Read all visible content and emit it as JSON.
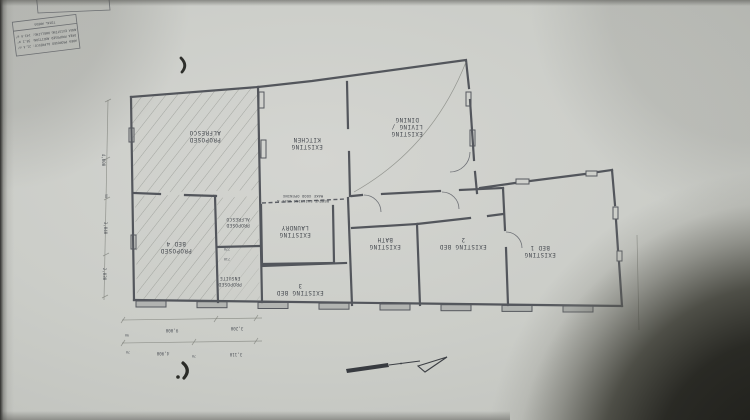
{
  "drawing": {
    "orientation_note": "plan photographed upside-down",
    "title_block": {
      "title": "TOTAL AREAS",
      "rows": [
        "AREA EXISTING DWELLING: 143.6 m²",
        "AREA PROPOSED ADDITION: 38.2 m²",
        "AREA PROPOSED ALFRESCO: 21.4 m²"
      ]
    },
    "rooms": {
      "alfresco1": {
        "l1": "PROPOSED",
        "l2": "ALFRESCO"
      },
      "kitchen": {
        "l1": "EXISTING",
        "l2": "KITCHEN"
      },
      "living": {
        "l1": "EXISTING",
        "l2": "LIVING /",
        "l3": "DINING"
      },
      "laundry": {
        "l1": "EXISTING",
        "l2": "LAUNDRY"
      },
      "alfresco2": {
        "l1": "PROPOSED",
        "l2": "ALFRESCO"
      },
      "bed4": {
        "l1": "PROPOSED",
        "l2": "BED 4"
      },
      "ensuite": {
        "l1": "PROPOSED",
        "l2": "ENSUITE"
      },
      "bed3": {
        "l1": "EXISTING BED",
        "l2": "3"
      },
      "bath": {
        "l1": "EXISTING",
        "l2": "BATH"
      },
      "bed2": {
        "l1": "EXISTING BED",
        "l2": "2"
      },
      "bed1": {
        "l1": "EXISTING",
        "l2": "BED 1"
      }
    },
    "notes": {
      "remove_wall_l1": "REMOVE EXISTING WALL &",
      "remove_wall_l2": "MAKE GOOD OPENING"
    },
    "dimensions": {
      "bottom_row1": [
        "9,000",
        "3,200"
      ],
      "bottom_row2": [
        "4,900",
        "70",
        "3,110"
      ],
      "bottom_small": [
        "90",
        "70"
      ],
      "left_side": [
        "4,000",
        "90",
        "3,040",
        "2,030"
      ],
      "ensuite": [
        "770",
        "710"
      ]
    },
    "icons": {
      "north_arrow": "north-arrow",
      "pen_mark": "crescent-pen-mark"
    },
    "colors": {
      "paper": "#cbcdc8",
      "ink": "#53565c",
      "shadow_corner": "#23231e"
    }
  }
}
